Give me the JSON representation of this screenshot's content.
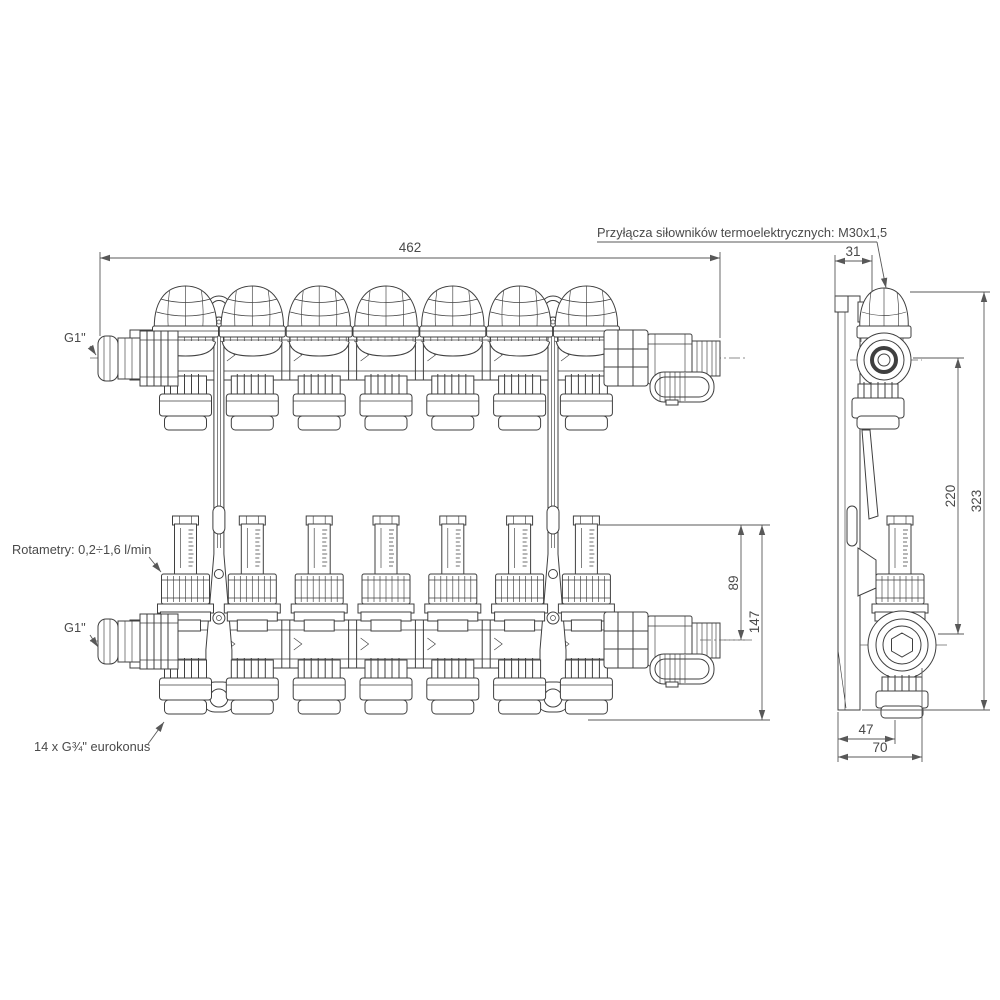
{
  "drawing": {
    "type": "technical-drawing",
    "ink_color": "#3f3f3f",
    "dim_color": "#585858",
    "circuits_per_bar": 7,
    "labels": {
      "actuator_thread": "Przyłącza siłowników termoelektrycznych: M30x1,5",
      "supply_inlet": "G1\"",
      "return_inlet": "G1\"",
      "rotameters": "Rotametry: 0,2÷1,6 l/min",
      "outlets": "14 x G¾\" eurokonus"
    },
    "dimensions": {
      "overall_width": "462",
      "actuator_offset": "31",
      "rotameter_to_valve_axis": "89",
      "rotameter_to_bottom": "147",
      "axis_to_axis": "220",
      "overall_height": "323",
      "wall_to_outlet_axis": "47",
      "overall_depth": "70"
    }
  }
}
